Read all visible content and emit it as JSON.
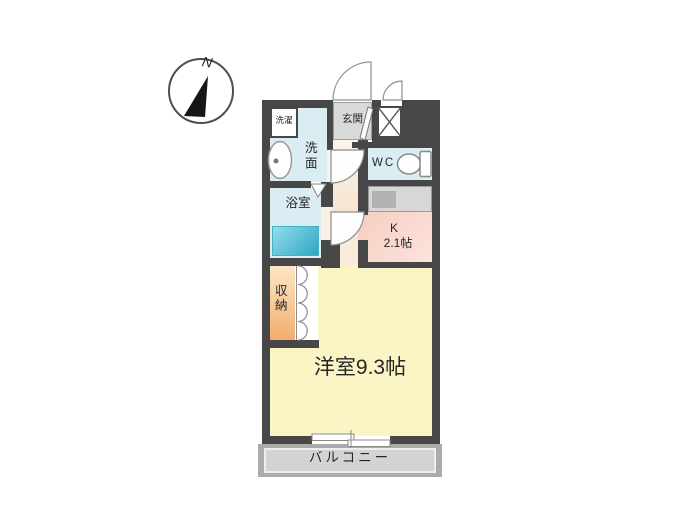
{
  "compass": {
    "north_label": "N"
  },
  "floor_plan": {
    "rooms": {
      "laundry": {
        "label": "洗濯"
      },
      "washroom": {
        "label": "洗面"
      },
      "entrance": {
        "label": "玄関"
      },
      "wc": {
        "label": "WC"
      },
      "bathroom": {
        "label": "浴室"
      },
      "kitchen": {
        "label": "K",
        "size": "2.1帖"
      },
      "storage": {
        "label": "収納"
      },
      "western_room": {
        "label": "洋室9.3帖"
      },
      "balcony": {
        "label": "バルコニー"
      }
    },
    "colors": {
      "wall": "#474747",
      "water_rooms": "#d9edf2",
      "bathtub": "#2ea7c5",
      "entrance_tile": "#d9d9d9",
      "hallway": "#f7e4d2",
      "kitchen": "#f6c9bc",
      "storage": "#f1ad6e",
      "western_room": "#fbf5c5",
      "balcony": "#d3d3d3"
    }
  }
}
